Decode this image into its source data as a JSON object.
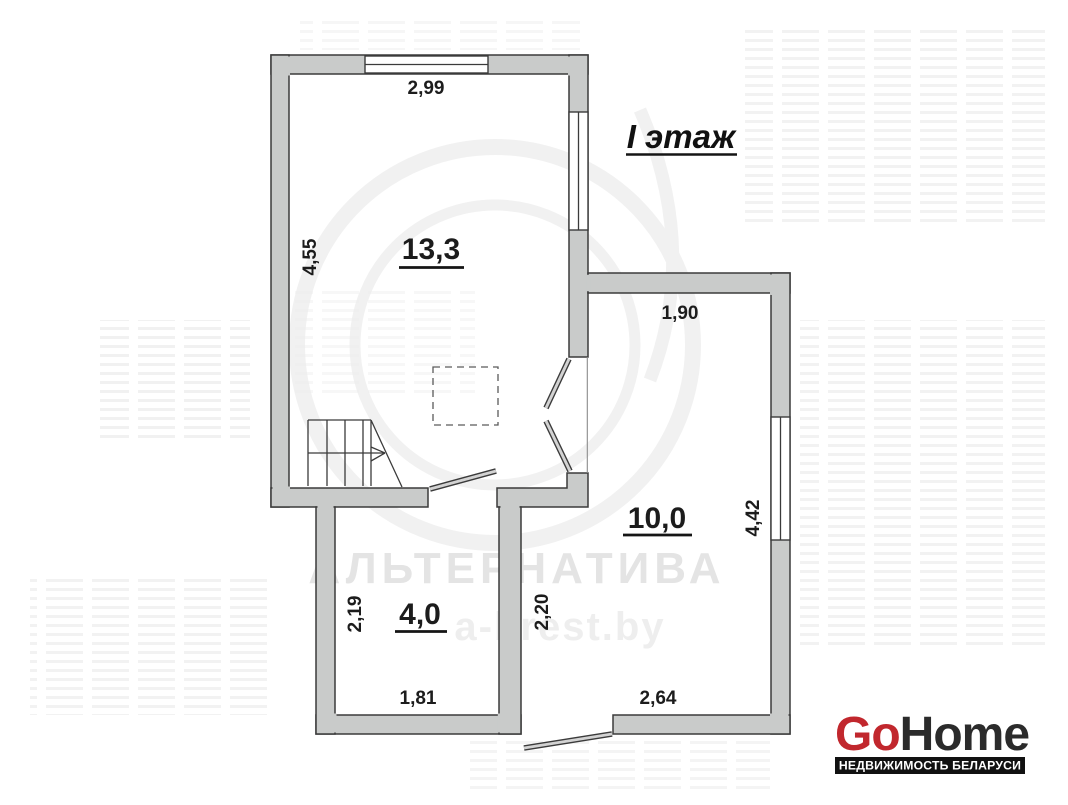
{
  "title": "I этаж",
  "rooms": {
    "r1": "13,3",
    "r2": "10,0",
    "r3": "4,0"
  },
  "dims": {
    "top_width": "2,99",
    "left_height": "4,55",
    "right_top_width": "1,90",
    "right_height": "4,42",
    "small_left_height": "2,19",
    "small_bottom_width": "1,81",
    "mid_height": "2,20",
    "bottom_right_width": "2,64"
  },
  "watermark": {
    "brand": "АЛЬТЕРНАТИВА",
    "site": "a-brest.by"
  },
  "logo": {
    "go": "Go",
    "home": "Home",
    "tagline": "НЕДВИЖИМОСТЬ БЕЛАРУСИ"
  },
  "colors": {
    "wall_fill": "#c9cbca",
    "wall_stroke": "#3b3b3b",
    "label": "#1c1c1c",
    "watermark": "#e4e4e4",
    "watermark_light": "#eeeeee",
    "logo_red": "#c1272d",
    "logo_dark": "#2b2b2b",
    "logo_bar": "#111111"
  }
}
